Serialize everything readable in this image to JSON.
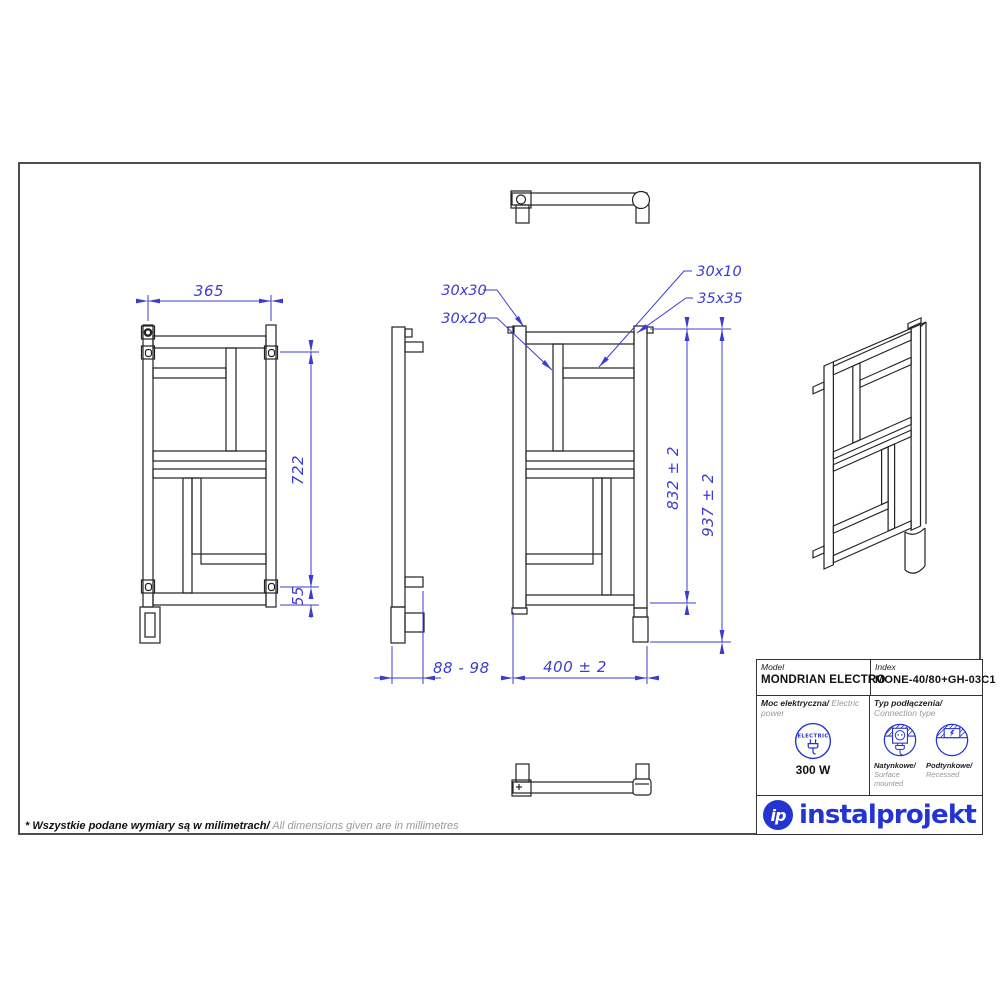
{
  "sheet": {
    "note_pl": "* Wszystkie podane wymiary są w milimetrach/",
    "note_en": " All dimensions given are in millimetres"
  },
  "dims": {
    "w365": "365",
    "h722": "722",
    "h55": "55",
    "depth": "88 - 98",
    "w400": "400  ± 2",
    "h832": "832  ± 2",
    "h937": "937  ± 2",
    "c3030": "30x30",
    "c3020": "30x20",
    "c3010": "30x10",
    "c3535": "35x35"
  },
  "title_block": {
    "model_label": "Model",
    "model_value": "MONDRIAN ELECTRO",
    "index_label": "Index",
    "index_value": "MONE-40/80+GH-03C1",
    "power_label_pl": "Moc elektryczna/",
    "power_label_en": " Electric power",
    "electric_icon_text": "ELECTRIC",
    "power_value": "300 W",
    "connection_label_pl": "Typ podłączenia/",
    "connection_label_en": "Connection type",
    "surface_pl": "Natynkowe/",
    "surface_en": "Surface mounted",
    "recessed_pl": "Podtynkowe/",
    "recessed_en": "Recessed",
    "brand_monogram": "ip",
    "brand": "instalprojekt"
  },
  "colors": {
    "dimension_blue": "#3c3ccf",
    "drawing_black": "#222222",
    "brand_blue": "#2434d2",
    "muted_gray": "#979797",
    "frame_gray": "#4d4d4d"
  }
}
